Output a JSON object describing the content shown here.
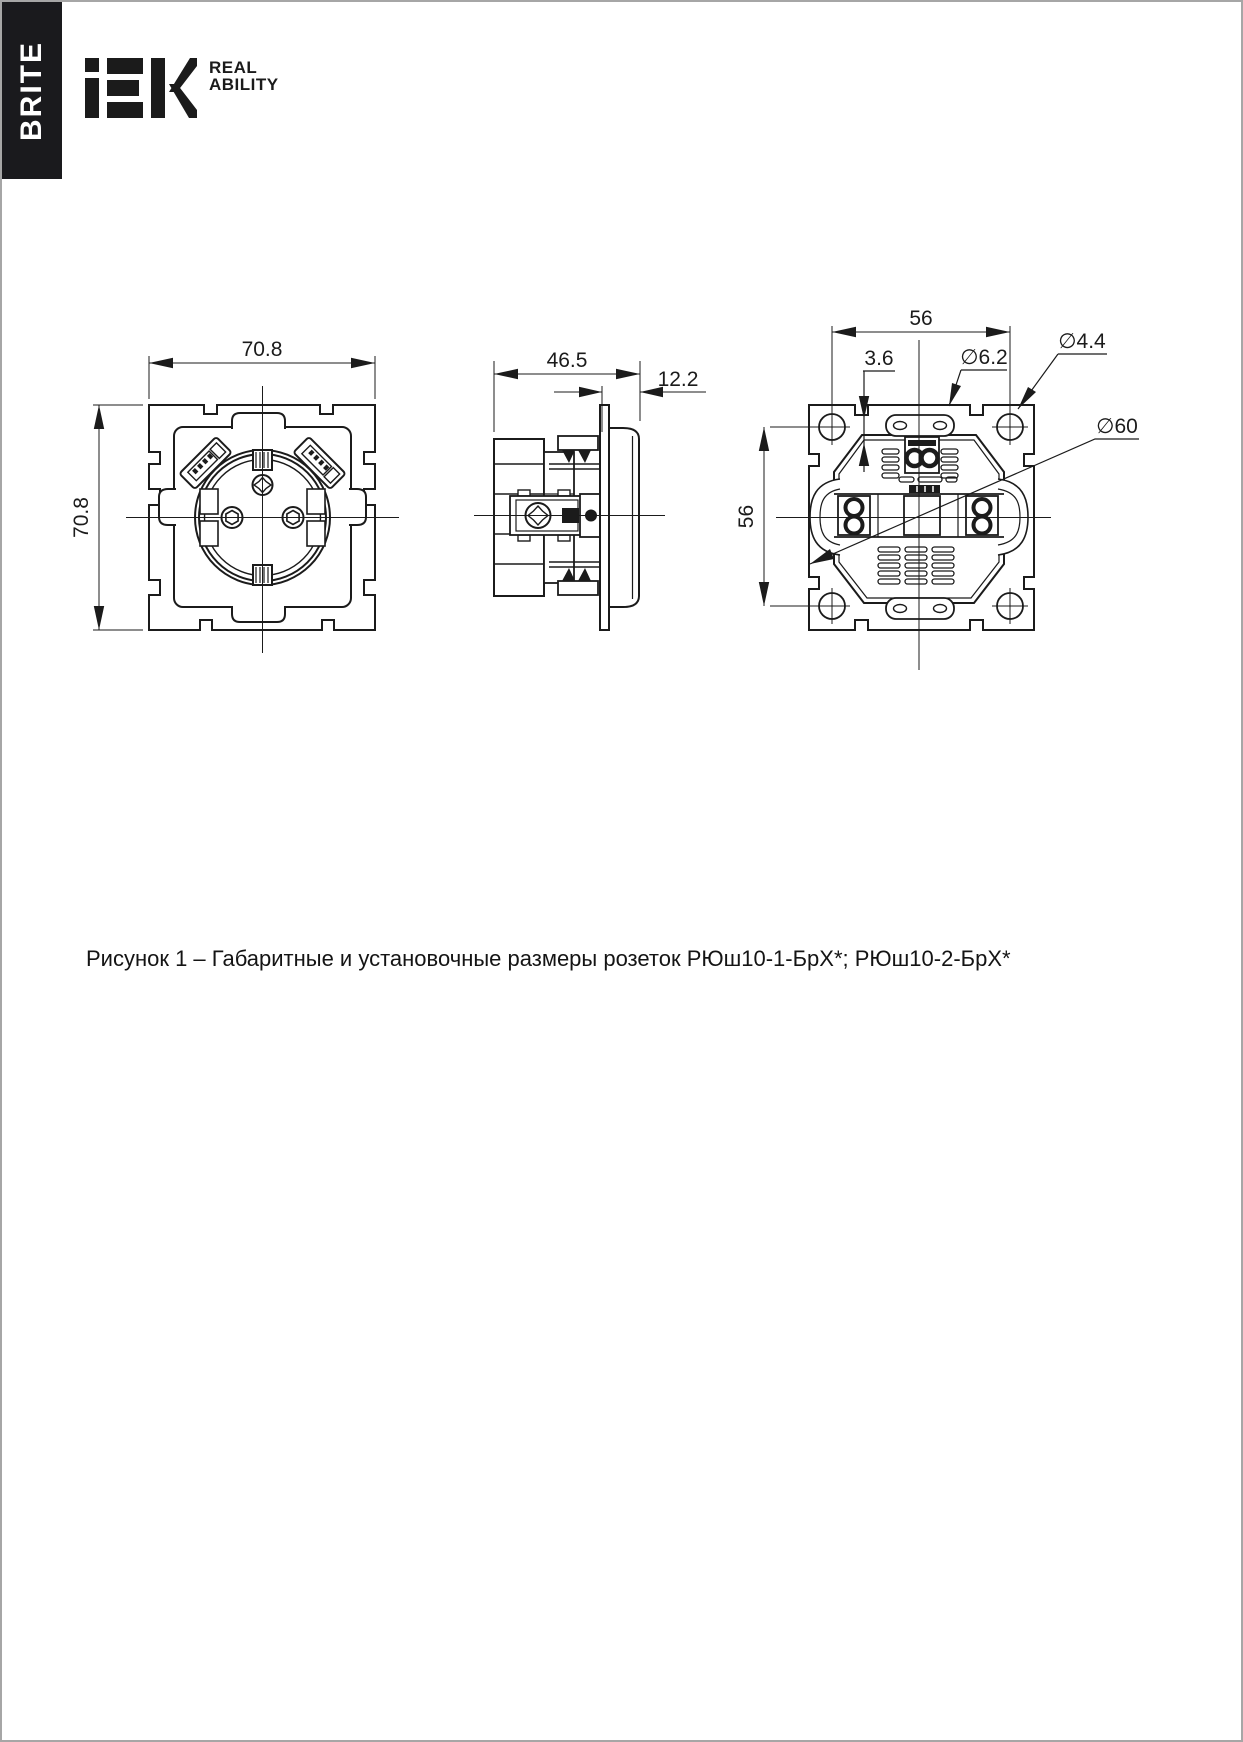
{
  "sidebar": {
    "label": "BRITE"
  },
  "brand": {
    "logo_text": "IEK",
    "tagline_line1": "REAL",
    "tagline_line2": "ABILITY"
  },
  "figure": {
    "caption": "Рисунок 1 – Габаритные и установочные размеры розеток РЮш10-1-БрХ*; РЮш10-2-БрХ*"
  },
  "dimensions": {
    "front_width": "70.8",
    "front_height": "70.8",
    "side_depth": "46.5",
    "side_front_protrusion": "12.2",
    "rear_hole_spacing_horizontal": "56",
    "rear_hole_spacing_vertical": "56",
    "rear_offset": "3.6",
    "rear_slot_diameter": "∅6.2",
    "rear_hole_diameter": "∅4.4",
    "rear_mechanism_diameter": "∅60"
  },
  "colors": {
    "ink": "#1b1b1b",
    "tab_background": "#1a1a1d",
    "page_border": "#a6a6a6"
  }
}
